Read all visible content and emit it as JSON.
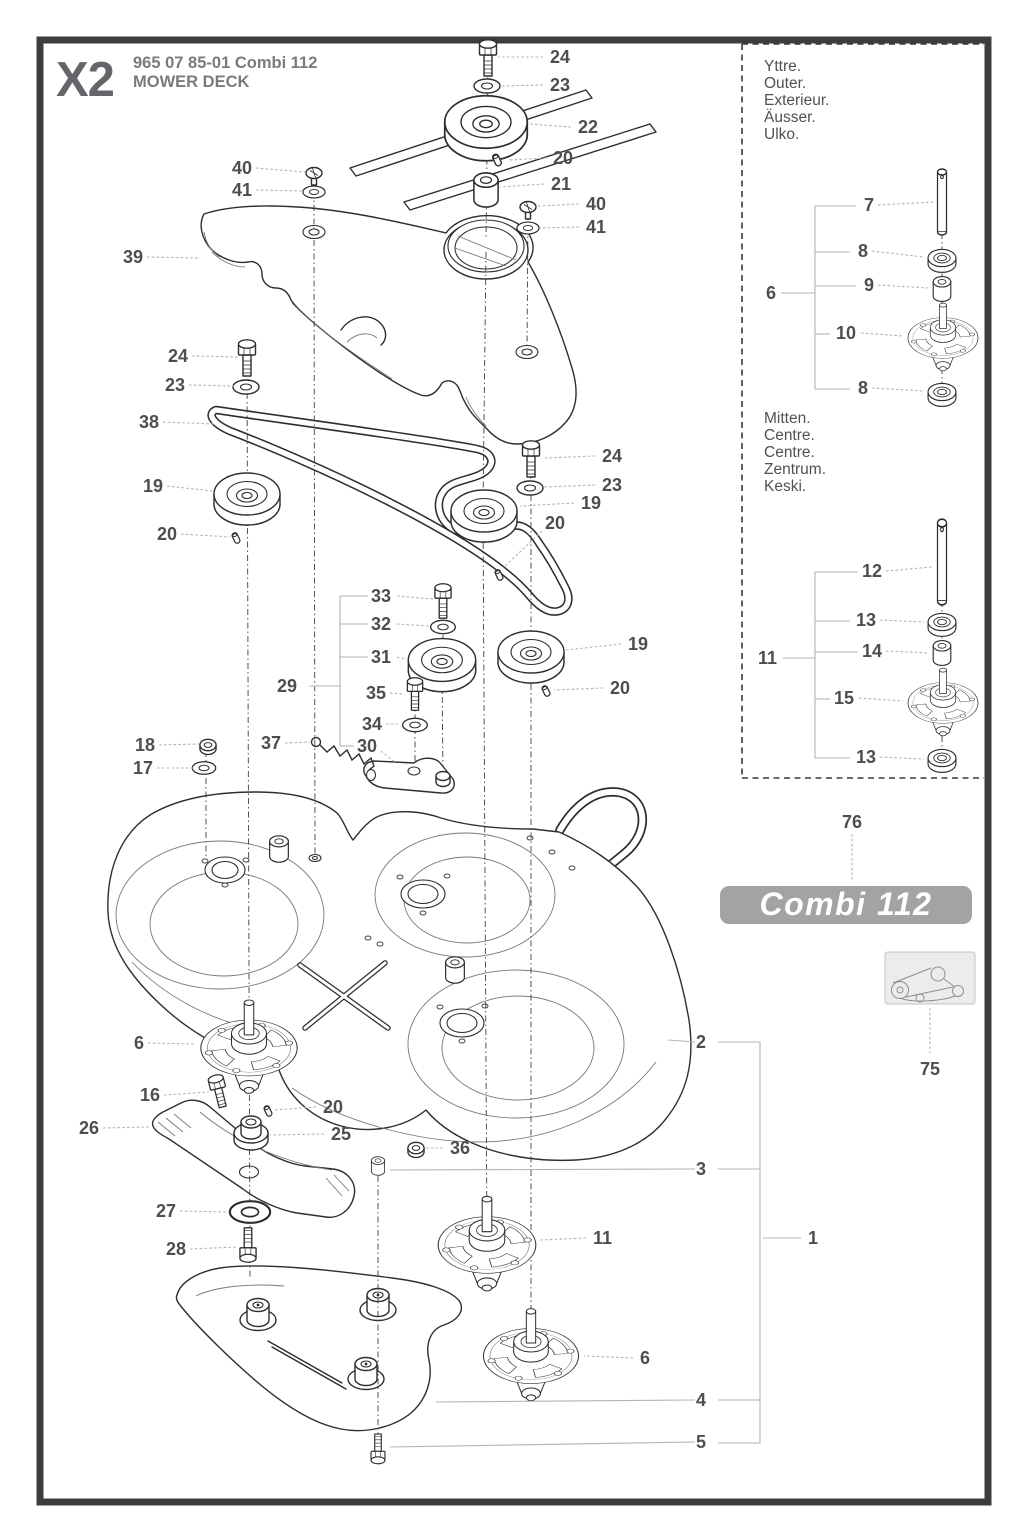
{
  "header": {
    "code": "X2",
    "part_number": "965 07 85-01 Combi 112",
    "title": "MOWER DECK"
  },
  "side_panel": {
    "outer_labels": [
      "Yttre.",
      "Outer.",
      "Exterieur.",
      "Äusser.",
      "Ulko."
    ],
    "centre_labels": [
      "Mitten.",
      "Centre.",
      "Centre.",
      "Zentrum.",
      "Keski."
    ]
  },
  "badge": {
    "text": "Combi 112",
    "bg_color": "#a3a3a3",
    "text_color": "#ffffff"
  },
  "colors": {
    "line": "#2e2e2e",
    "label": "#4e4e52",
    "leader": "#b3b3b4",
    "frame": "#3d3d3d"
  },
  "diagram": {
    "callouts": [
      {
        "t": "24",
        "x": 550,
        "y": 57,
        "lead": [
          [
            543,
            57
          ],
          [
            498,
            57
          ]
        ]
      },
      {
        "t": "23",
        "x": 550,
        "y": 85,
        "lead": [
          [
            543,
            85
          ],
          [
            500,
            86
          ]
        ]
      },
      {
        "t": "22",
        "x": 578,
        "y": 127,
        "lead": [
          [
            571,
            127
          ],
          [
            530,
            124
          ]
        ]
      },
      {
        "t": "20",
        "x": 553,
        "y": 158,
        "lead": [
          [
            546,
            158
          ],
          [
            508,
            160
          ]
        ]
      },
      {
        "t": "21",
        "x": 551,
        "y": 184,
        "lead": [
          [
            544,
            184
          ],
          [
            500,
            187
          ]
        ]
      },
      {
        "t": "40",
        "x": 586,
        "y": 204,
        "lead": [
          [
            579,
            204
          ],
          [
            538,
            206
          ]
        ]
      },
      {
        "t": "41",
        "x": 586,
        "y": 227,
        "lead": [
          [
            579,
            227
          ],
          [
            540,
            228
          ]
        ]
      },
      {
        "t": "40",
        "x": 252,
        "y": 168,
        "a": "end",
        "lead": [
          [
            256,
            168
          ],
          [
            305,
            172
          ]
        ]
      },
      {
        "t": "41",
        "x": 252,
        "y": 190,
        "a": "end",
        "lead": [
          [
            256,
            190
          ],
          [
            303,
            191
          ]
        ]
      },
      {
        "t": "39",
        "x": 143,
        "y": 257,
        "a": "end",
        "lead": [
          [
            147,
            257
          ],
          [
            199,
            258
          ]
        ]
      },
      {
        "t": "24",
        "x": 188,
        "y": 356,
        "a": "end",
        "lead": [
          [
            192,
            356
          ],
          [
            238,
            357
          ]
        ]
      },
      {
        "t": "23",
        "x": 185,
        "y": 385,
        "a": "end",
        "lead": [
          [
            189,
            385
          ],
          [
            234,
            386
          ]
        ]
      },
      {
        "t": "38",
        "x": 159,
        "y": 422,
        "a": "end",
        "lead": [
          [
            163,
            422
          ],
          [
            214,
            424
          ]
        ]
      },
      {
        "t": "19",
        "x": 163,
        "y": 486,
        "a": "end",
        "lead": [
          [
            167,
            486
          ],
          [
            212,
            491
          ]
        ]
      },
      {
        "t": "20",
        "x": 177,
        "y": 534,
        "a": "end",
        "lead": [
          [
            181,
            534
          ],
          [
            230,
            537
          ]
        ]
      },
      {
        "t": "18",
        "x": 155,
        "y": 745,
        "a": "end",
        "lead": [
          [
            159,
            745
          ],
          [
            199,
            744
          ]
        ]
      },
      {
        "t": "17",
        "x": 153,
        "y": 768,
        "a": "end",
        "lead": [
          [
            157,
            768
          ],
          [
            194,
            768
          ]
        ]
      },
      {
        "t": "37",
        "x": 281,
        "y": 743,
        "a": "end",
        "lead": [
          [
            285,
            743
          ],
          [
            310,
            742
          ]
        ]
      },
      {
        "t": "33",
        "x": 371,
        "y": 596,
        "lead": [
          [
            397,
            596
          ],
          [
            434,
            599
          ]
        ]
      },
      {
        "t": "32",
        "x": 371,
        "y": 624,
        "lead": [
          [
            397,
            624
          ],
          [
            430,
            626
          ]
        ]
      },
      {
        "t": "31",
        "x": 371,
        "y": 657,
        "lead": [
          [
            397,
            657
          ],
          [
            407,
            659
          ]
        ]
      },
      {
        "t": "29",
        "x": 297,
        "y": 686,
        "a": "end"
      },
      {
        "t": "35",
        "x": 366,
        "y": 693,
        "lead": [
          [
            390,
            693
          ],
          [
            404,
            694
          ]
        ]
      },
      {
        "t": "34",
        "x": 362,
        "y": 724,
        "lead": [
          [
            386,
            724
          ],
          [
            400,
            724
          ]
        ]
      },
      {
        "t": "30",
        "x": 357,
        "y": 746,
        "lead": [
          [
            381,
            751
          ],
          [
            396,
            763
          ]
        ]
      },
      {
        "t": "24",
        "x": 602,
        "y": 456,
        "lead": [
          [
            595,
            456
          ],
          [
            545,
            458
          ]
        ]
      },
      {
        "t": "23",
        "x": 602,
        "y": 485,
        "lead": [
          [
            595,
            485
          ],
          [
            544,
            487
          ]
        ]
      },
      {
        "t": "19",
        "x": 581,
        "y": 503,
        "lead": [
          [
            574,
            503
          ],
          [
            520,
            506
          ]
        ]
      },
      {
        "t": "20",
        "x": 545,
        "y": 523,
        "lead": [
          [
            542,
            531
          ],
          [
            503,
            568
          ]
        ]
      },
      {
        "t": "19",
        "x": 628,
        "y": 644,
        "lead": [
          [
            621,
            644
          ],
          [
            566,
            650
          ]
        ]
      },
      {
        "t": "20",
        "x": 610,
        "y": 688,
        "lead": [
          [
            603,
            688
          ],
          [
            554,
            690
          ]
        ]
      },
      {
        "t": "6",
        "x": 144,
        "y": 1043,
        "a": "end",
        "lead": [
          [
            148,
            1043
          ],
          [
            196,
            1044
          ]
        ]
      },
      {
        "t": "16",
        "x": 160,
        "y": 1095,
        "a": "end",
        "lead": [
          [
            164,
            1095
          ],
          [
            209,
            1092
          ]
        ]
      },
      {
        "t": "26",
        "x": 99,
        "y": 1128,
        "a": "end",
        "lead": [
          [
            103,
            1128
          ],
          [
            150,
            1127
          ]
        ]
      },
      {
        "t": "20",
        "x": 323,
        "y": 1107,
        "lead": [
          [
            316,
            1107
          ],
          [
            273,
            1110
          ]
        ]
      },
      {
        "t": "25",
        "x": 331,
        "y": 1134,
        "lead": [
          [
            324,
            1134
          ],
          [
            270,
            1135
          ]
        ]
      },
      {
        "t": "36",
        "x": 450,
        "y": 1148,
        "lead": [
          [
            443,
            1148
          ],
          [
            426,
            1148
          ]
        ]
      },
      {
        "t": "27",
        "x": 176,
        "y": 1211,
        "a": "end",
        "lead": [
          [
            180,
            1211
          ],
          [
            229,
            1212
          ]
        ]
      },
      {
        "t": "28",
        "x": 186,
        "y": 1249,
        "a": "end",
        "lead": [
          [
            190,
            1249
          ],
          [
            237,
            1247
          ]
        ]
      },
      {
        "t": "2",
        "x": 706,
        "y": 1042,
        "a": "end"
      },
      {
        "t": "3",
        "x": 706,
        "y": 1169,
        "a": "end"
      },
      {
        "t": "11",
        "x": 593,
        "y": 1238,
        "lead": [
          [
            586,
            1238
          ],
          [
            540,
            1240
          ]
        ]
      },
      {
        "t": "1",
        "x": 808,
        "y": 1238
      },
      {
        "t": "6",
        "x": 640,
        "y": 1358,
        "lead": [
          [
            633,
            1358
          ],
          [
            584,
            1356
          ]
        ]
      },
      {
        "t": "4",
        "x": 706,
        "y": 1400,
        "a": "end"
      },
      {
        "t": "5",
        "x": 706,
        "y": 1442,
        "a": "end"
      },
      {
        "t": "7",
        "x": 864,
        "y": 205,
        "lead": [
          [
            878,
            205
          ],
          [
            934,
            202
          ]
        ]
      },
      {
        "t": "8",
        "x": 858,
        "y": 251,
        "lead": [
          [
            872,
            251
          ],
          [
            924,
            257
          ]
        ]
      },
      {
        "t": "9",
        "x": 864,
        "y": 285,
        "lead": [
          [
            878,
            285
          ],
          [
            928,
            288
          ]
        ]
      },
      {
        "t": "10",
        "x": 836,
        "y": 333,
        "lead": [
          [
            861,
            333
          ],
          [
            903,
            336
          ]
        ]
      },
      {
        "t": "8",
        "x": 858,
        "y": 388,
        "lead": [
          [
            872,
            388
          ],
          [
            924,
            391
          ]
        ]
      },
      {
        "t": "6",
        "x": 766,
        "y": 293
      },
      {
        "t": "12",
        "x": 862,
        "y": 571,
        "lead": [
          [
            886,
            571
          ],
          [
            932,
            567
          ]
        ]
      },
      {
        "t": "13",
        "x": 856,
        "y": 620,
        "lead": [
          [
            880,
            620
          ],
          [
            924,
            622
          ]
        ]
      },
      {
        "t": "14",
        "x": 862,
        "y": 651,
        "lead": [
          [
            886,
            651
          ],
          [
            928,
            653
          ]
        ]
      },
      {
        "t": "15",
        "x": 834,
        "y": 698,
        "lead": [
          [
            859,
            698
          ],
          [
            903,
            701
          ]
        ]
      },
      {
        "t": "13",
        "x": 856,
        "y": 757,
        "lead": [
          [
            880,
            757
          ],
          [
            924,
            759
          ]
        ]
      },
      {
        "t": "11",
        "x": 758,
        "y": 658
      },
      {
        "t": "76",
        "x": 852,
        "y": 822,
        "a": "middle",
        "lead": [
          [
            852,
            834
          ],
          [
            852,
            882
          ]
        ]
      },
      {
        "t": "75",
        "x": 930,
        "y": 1069,
        "a": "middle",
        "lead": [
          [
            930,
            1008
          ],
          [
            930,
            1053
          ]
        ]
      }
    ],
    "brackets": [
      [
        [
          668,
          1040
        ],
        [
          695,
          1042
        ]
      ],
      [
        [
          390,
          1170
        ],
        [
          695,
          1169
        ]
      ],
      [
        [
          436,
          1402
        ],
        [
          695,
          1400
        ]
      ],
      [
        [
          390,
          1447
        ],
        [
          695,
          1442
        ]
      ],
      [
        [
          718,
          1042
        ],
        [
          760,
          1042
        ],
        [
          760,
          1443
        ],
        [
          718,
          1443
        ]
      ],
      [
        [
          718,
          1169
        ],
        [
          760,
          1169
        ]
      ],
      [
        [
          718,
          1400
        ],
        [
          760,
          1400
        ]
      ],
      [
        [
          763,
          1238
        ],
        [
          801,
          1238
        ]
      ],
      [
        [
          309,
          686
        ],
        [
          340,
          686
        ]
      ],
      [
        [
          340,
          596
        ],
        [
          340,
          746
        ]
      ],
      [
        [
          340,
          596
        ],
        [
          368,
          596
        ]
      ],
      [
        [
          340,
          624
        ],
        [
          368,
          624
        ]
      ],
      [
        [
          340,
          657
        ],
        [
          368,
          657
        ]
      ],
      [
        [
          340,
          746
        ],
        [
          354,
          746
        ]
      ],
      [
        [
          781,
          293
        ],
        [
          815,
          293
        ],
        [
          815,
          206
        ],
        [
          856,
          206
        ]
      ],
      [
        [
          815,
          252
        ],
        [
          850,
          252
        ]
      ],
      [
        [
          815,
          286
        ],
        [
          856,
          286
        ]
      ],
      [
        [
          815,
          334
        ],
        [
          830,
          334
        ]
      ],
      [
        [
          815,
          293
        ],
        [
          815,
          389
        ],
        [
          850,
          389
        ]
      ],
      [
        [
          783,
          658
        ],
        [
          815,
          658
        ],
        [
          815,
          572
        ],
        [
          858,
          572
        ]
      ],
      [
        [
          815,
          621
        ],
        [
          850,
          621
        ]
      ],
      [
        [
          815,
          652
        ],
        [
          858,
          652
        ]
      ],
      [
        [
          815,
          699
        ],
        [
          830,
          699
        ]
      ],
      [
        [
          815,
          658
        ],
        [
          815,
          758
        ],
        [
          850,
          758
        ]
      ]
    ],
    "axis_lines": [
      [
        488,
        64,
        486,
        238
      ],
      [
        486,
        252,
        483,
        506
      ],
      [
        483,
        516,
        487,
        1242
      ],
      [
        314,
        178,
        314,
        229
      ],
      [
        314,
        240,
        315,
        854
      ],
      [
        528,
        214,
        527,
        347
      ],
      [
        247,
        366,
        250,
        1278
      ],
      [
        531,
        468,
        531,
        1352
      ],
      [
        443,
        608,
        443,
        650
      ],
      [
        442,
        670,
        443,
        778
      ],
      [
        415,
        701,
        415,
        764
      ],
      [
        206,
        751,
        206,
        858
      ],
      [
        942,
        233,
        942,
        387
      ],
      [
        942,
        601,
        942,
        754
      ],
      [
        378,
        1176,
        378,
        1440
      ]
    ]
  }
}
